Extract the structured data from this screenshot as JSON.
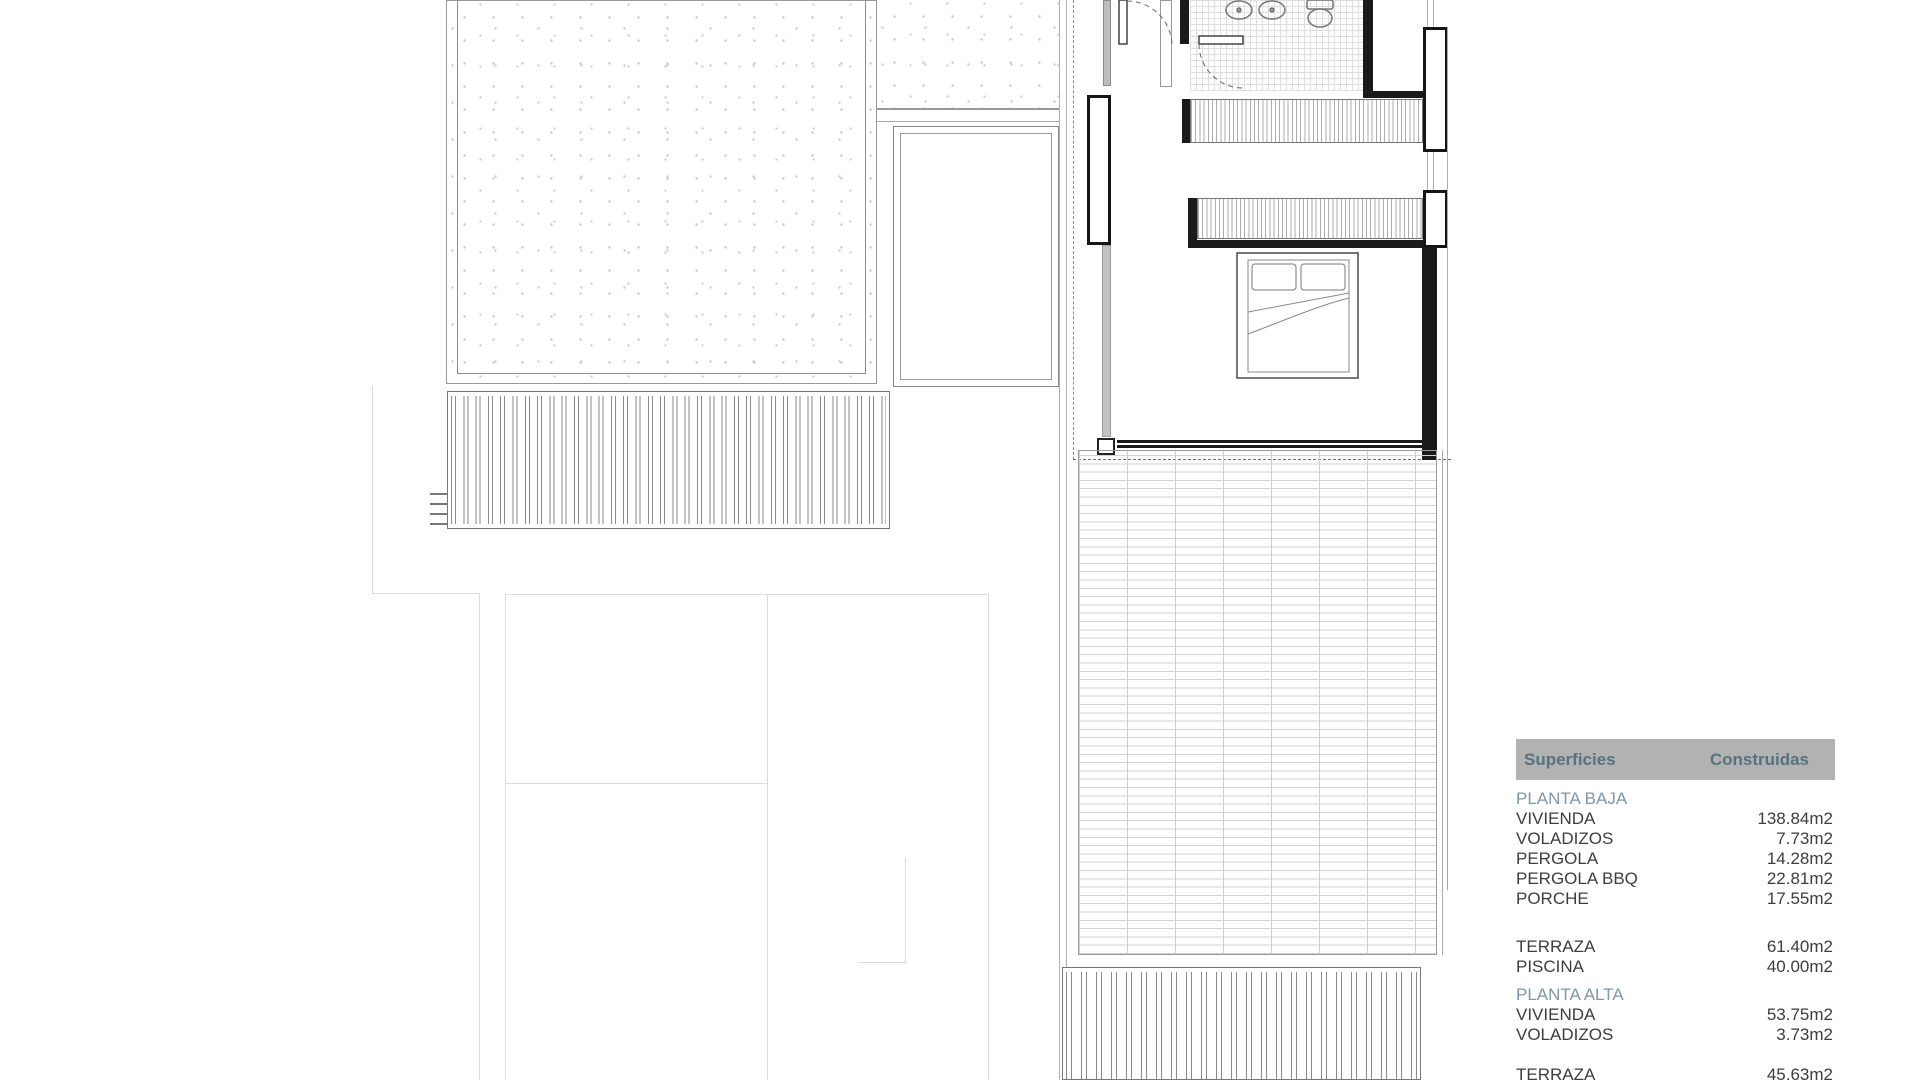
{
  "legend": {
    "header": {
      "col1": "Superficies",
      "col2": "Construidas"
    },
    "rows": [
      {
        "label": "PLANTA BAJA",
        "value": "",
        "type": "group"
      },
      {
        "label": "VIVIENDA",
        "value": "138.84m2"
      },
      {
        "label": "VOLADIZOS",
        "value": "7.73m2"
      },
      {
        "label": "PERGOLA",
        "value": "14.28m2"
      },
      {
        "label": "PERGOLA BBQ",
        "value": "22.81m2"
      },
      {
        "label": "PORCHE",
        "value": "17.55m2"
      },
      {
        "label": "TERRAZA",
        "value": "61.40m2"
      },
      {
        "label": "PISCINA",
        "value": "40.00m2"
      },
      {
        "label": "PLANTA ALTA",
        "value": "",
        "type": "group"
      },
      {
        "label": "VIVIENDA",
        "value": "53.75m2"
      },
      {
        "label": "VOLADIZOS",
        "value": "3.73m2"
      },
      {
        "label": "TERRAZA",
        "value": "45.63m2"
      }
    ],
    "colors": {
      "header_bg": "#b2b2b2",
      "header_text": "#56737f",
      "group_text": "#7e98a6",
      "row_text": "#3d3d3d"
    }
  },
  "plan_symbols": [
    "gravel-roof",
    "pergola-slats",
    "double-bed",
    "wardrobe",
    "washbasin",
    "washbasin",
    "toilet",
    "door-swing",
    "door-swing",
    "tiled-terrace",
    "pool-outline"
  ]
}
